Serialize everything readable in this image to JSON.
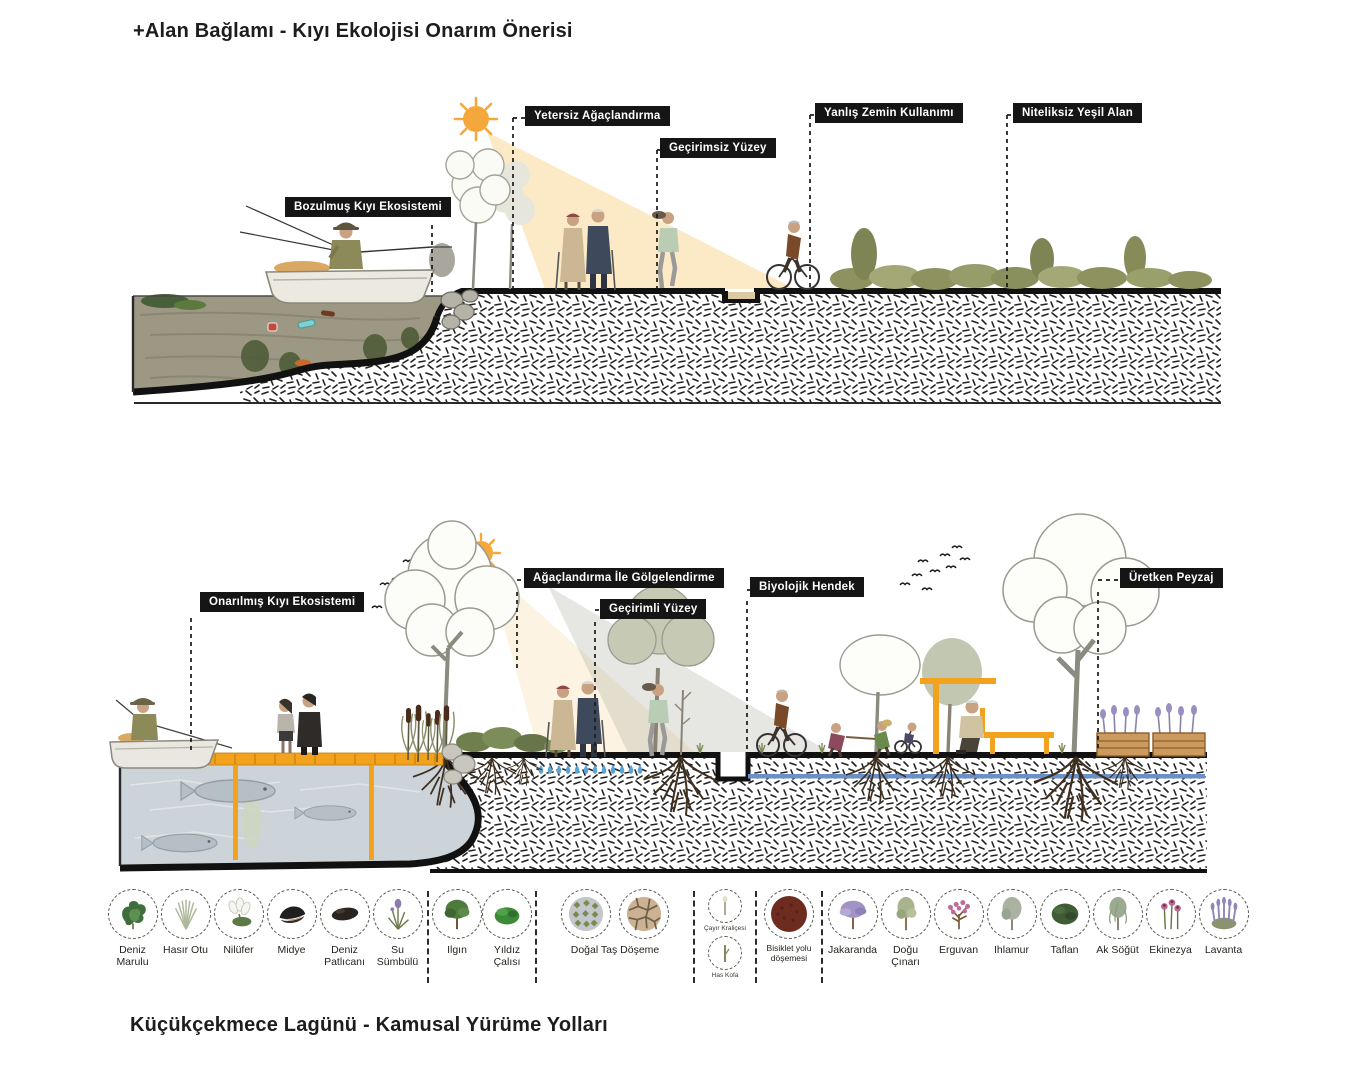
{
  "titles": {
    "top": "+Alan Bağlamı - Kıyı Ekolojisi Onarım Önerisi",
    "bottom": "Küçükçekmece Lagünü - Kamusal Yürüme Yolları"
  },
  "diagram_top": {
    "name": "Bozulmuş kıyı kesiti (mevcut durum)",
    "labels": [
      "Bozulmuş Kıyı Ekosistemi",
      "Yetersiz Ağaçlandırma",
      "Geçirimsiz Yüzey",
      "Yanlış Zemin Kullanımı",
      "Niteliksiz Yeşil Alan"
    ]
  },
  "diagram_bottom": {
    "name": "Onarılmış kıyı kesiti (öneri)",
    "labels": [
      "Onarılmış Kıyı Ekosistemi",
      "Ağaçlandırma İle Gölgelendirme",
      "Geçirimli Yüzey",
      "Biyolojik Hendek",
      "Üretken Peyzaj"
    ]
  },
  "legend": {
    "items": [
      {
        "label": "Deniz Marulu",
        "icon": "sea-lettuce-icon"
      },
      {
        "label": "Hasır Otu",
        "icon": "rush-grass-icon"
      },
      {
        "label": "Nilüfer",
        "icon": "water-lily-icon"
      },
      {
        "label": "Midye",
        "icon": "mussel-icon"
      },
      {
        "label": "Deniz Patlıcanı",
        "icon": "sea-cucumber-icon"
      },
      {
        "label": "Su Sümbülü",
        "icon": "water-hyacinth-icon"
      },
      {
        "label": "Ilgın",
        "icon": "tamarisk-tree-icon"
      },
      {
        "label": "Yıldız Çalısı",
        "icon": "star-bush-icon"
      },
      {
        "label": "Doğal Taş Döşeme",
        "icon": "natural-stone-paving-icon"
      },
      {
        "label": "Çayır Kraliçesi",
        "icon": "meadowsweet-icon"
      },
      {
        "label": "Has Kofa",
        "icon": "bulrush-icon"
      },
      {
        "label": "Bisiklet yolu döşemesi",
        "icon": "bike-path-surface-icon"
      },
      {
        "label": "Jakaranda",
        "icon": "jacaranda-tree-icon"
      },
      {
        "label": "Doğu Çınarı",
        "icon": "plane-tree-icon"
      },
      {
        "label": "Erguvan",
        "icon": "judas-tree-icon"
      },
      {
        "label": "Ihlamur",
        "icon": "linden-tree-icon"
      },
      {
        "label": "Taflan",
        "icon": "laurel-bush-icon"
      },
      {
        "label": "Ak Söğüt",
        "icon": "white-willow-icon"
      },
      {
        "label": "Ekinezya",
        "icon": "echinacea-icon"
      },
      {
        "label": "Lavanta",
        "icon": "lavender-icon"
      }
    ]
  },
  "colors": {
    "accent_orange": "#f2a21c",
    "label_bg": "#151515",
    "label_text": "#ffffff",
    "polluted_water": "#9d9883",
    "clean_water": "#ccd4d9",
    "sun": "#f4a83c",
    "subsurface_water": "#6b8fc9",
    "droplet_blue": "#58a3d8",
    "bike_path_surface": "#6e2b20"
  }
}
